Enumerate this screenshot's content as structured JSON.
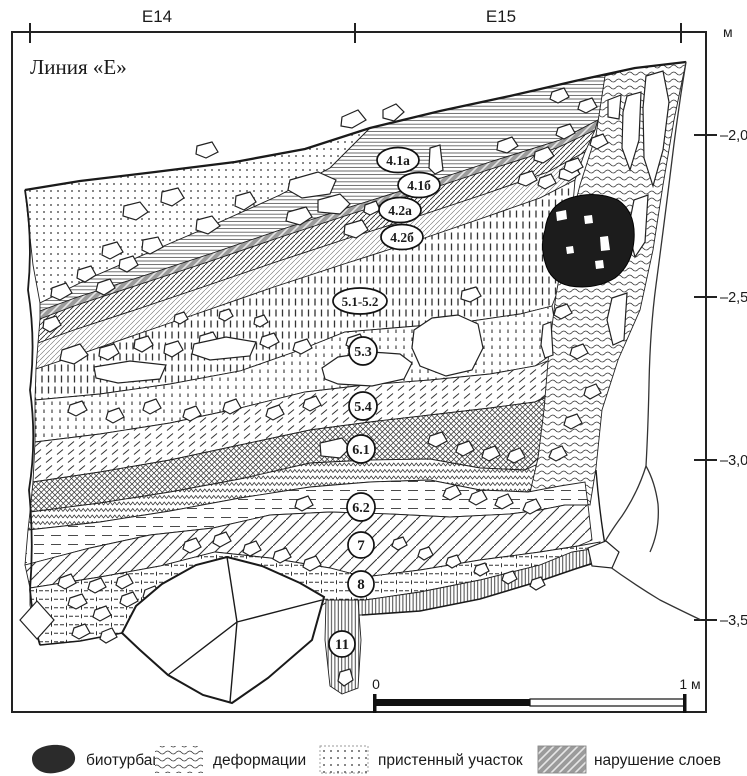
{
  "figure": {
    "title": "Линия «Е»",
    "grid": {
      "col1": "E14",
      "col2": "E15",
      "unit": "м"
    },
    "depth_ticks": [
      "–2,0",
      "–2,5",
      "–3,0",
      "–3,5"
    ],
    "layer_labels": [
      "4.1а",
      "4.1б",
      "4.2а",
      "4.2б",
      "5.1-5.2",
      "5.3",
      "5.4",
      "6.1",
      "6.2",
      "7",
      "8",
      "11"
    ],
    "scale_bar": {
      "start": "0",
      "end": "1 м"
    },
    "legend": [
      {
        "swatch": "blob",
        "label": "биотурбации"
      },
      {
        "swatch": "waves",
        "label": "деформации"
      },
      {
        "swatch": "dots",
        "label": "пристенный участок"
      },
      {
        "swatch": "gray-hatch",
        "label": "нарушение слоев"
      }
    ]
  }
}
